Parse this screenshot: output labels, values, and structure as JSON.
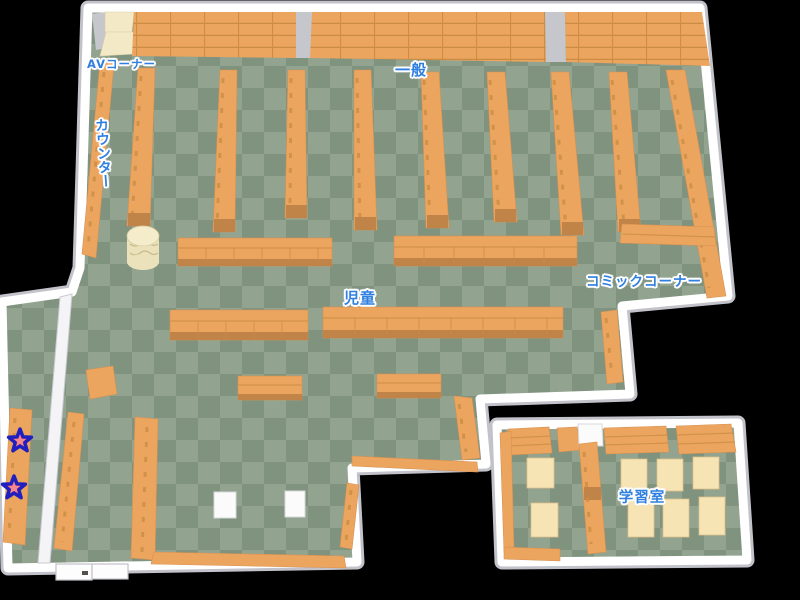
{
  "map": {
    "background": "#000000",
    "areas": [
      {
        "id": "av-corner",
        "label": "AVコーナー"
      },
      {
        "id": "counter",
        "label": "カウンター"
      },
      {
        "id": "general",
        "label": "一般"
      },
      {
        "id": "children",
        "label": "児童"
      },
      {
        "id": "comic-corner",
        "label": "コミックコーナー"
      },
      {
        "id": "study-room",
        "label": "学習室"
      }
    ],
    "markers": [
      {
        "id": "star-1",
        "shape": "star",
        "fill": "#EF5560",
        "outline": "#2020C0"
      },
      {
        "id": "star-2",
        "shape": "star",
        "fill": "#EF5560",
        "outline": "#2020C0"
      }
    ],
    "colors": {
      "background": "#000000",
      "floor-light": "#92A390",
      "floor-dark": "#80937F",
      "shelf": "#ECA55F",
      "shelf-line": "#C98C42",
      "shelf-base": "#C08449",
      "wall-top": "#FFFFFF",
      "wall-edge": "#C2C2CA",
      "beige": "#F3E9C6",
      "table": "#F6E4B5",
      "cylinder": "#EBE2BB",
      "label": "#2E7FE0",
      "star-fill": "#EF5560",
      "star-outline": "#2020C0"
    }
  }
}
